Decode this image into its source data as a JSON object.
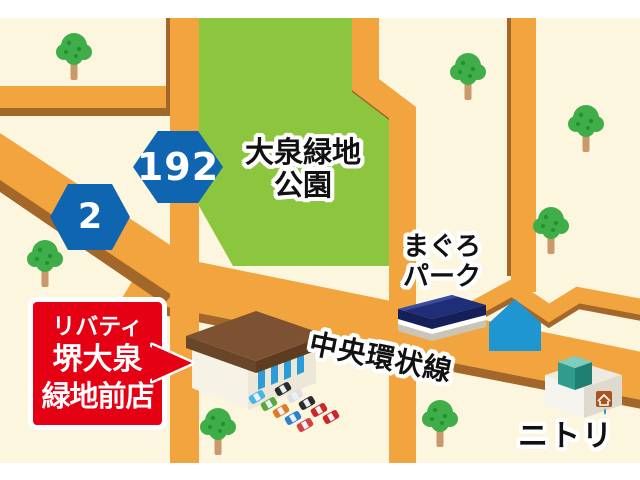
{
  "map": {
    "park_label": {
      "line1": "大泉緑地",
      "line2": "公園"
    },
    "route_signs": [
      {
        "number": "192"
      },
      {
        "number": "2"
      }
    ],
    "poi": {
      "maguro": {
        "line1": "まぐろ",
        "line2": "パーク"
      },
      "road_name": "中央環状線",
      "nitori": "ニトリ"
    },
    "store_callout": {
      "line1": "リバティ",
      "line2": "堺大泉",
      "line3": "緑地前店"
    }
  },
  "colors": {
    "bg_page": "#FFFFFF",
    "map_bg": "#FCF6DF",
    "road": "#F2A43E",
    "road_shadow": "#A4672A",
    "park_green": "#8CC63E",
    "tree_green": "#3FAE49",
    "tree_green_dark": "#22912F",
    "tree_trunk": "#C9996B",
    "sign_blue": "#0F65B0",
    "callout_red": "#E60013",
    "house_blue": "#1E96D2",
    "roof_brown": "#7C5233",
    "roof_brown_dark": "#69452A",
    "wall_white": "#F6F2E6",
    "wall_shade": "#EDE7D8",
    "shutter_blue": "#2B9CD8",
    "maguro_roof": "#1F2E78",
    "nitori_teal": "#2F9C8E",
    "nitori_teal_dark": "#1F7F72",
    "nitori_teal_light": "#7FCDBF",
    "logo_brown": "#A8541F",
    "text_dark": "#111111"
  }
}
